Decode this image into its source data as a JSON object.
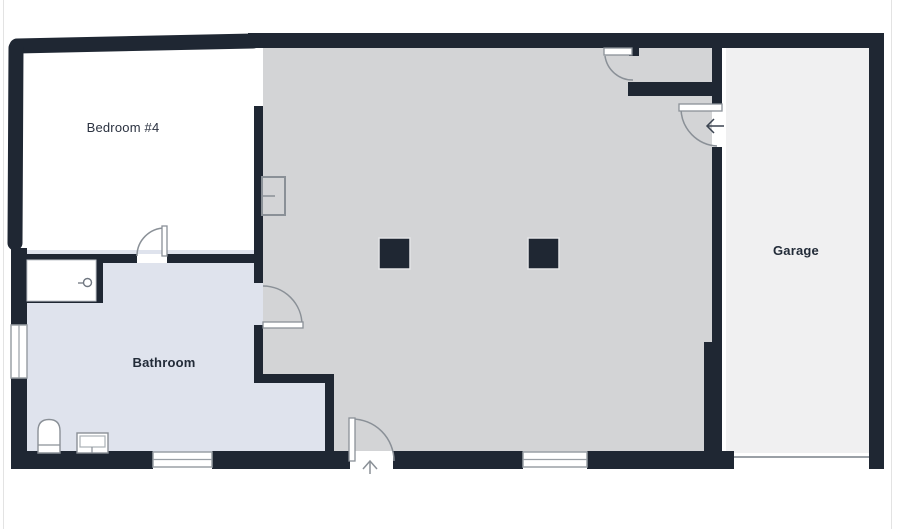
{
  "canvas": {
    "width": 900,
    "height": 529,
    "background": "#ffffff"
  },
  "palette": {
    "wall": "#1f2733",
    "bedroom_fill": "#ffffff",
    "main_room_fill": "#d3d4d6",
    "bathroom_fill": "#dfe3ed",
    "garage_fill": "#f0f0f1",
    "door_swing_line": "#8a9097",
    "window_frame": "#9aa0a6",
    "label_text": "#222b38"
  },
  "rooms": {
    "bedroom4": {
      "label": "Bedroom #4"
    },
    "bathroom": {
      "label": "Bathroom"
    },
    "garage": {
      "label": "Garage"
    },
    "main": {
      "label": ""
    }
  },
  "doors": [
    "bedroom-door",
    "bathroom-door",
    "front-entry-door",
    "closet-door",
    "garage-entry-door"
  ],
  "windows": [
    "left-wall-window",
    "bathroom-bottom-window",
    "main-room-bottom-window"
  ],
  "garage_overhead_door": "garage-overhead-door",
  "fixtures": [
    "shower",
    "shower-control",
    "toilet",
    "sink-vanity",
    "wall-panel",
    "column-post",
    "column-post"
  ],
  "entry_direction_arrows": [
    "up-arrow-front-entry",
    "left-arrow-garage-entry"
  ]
}
